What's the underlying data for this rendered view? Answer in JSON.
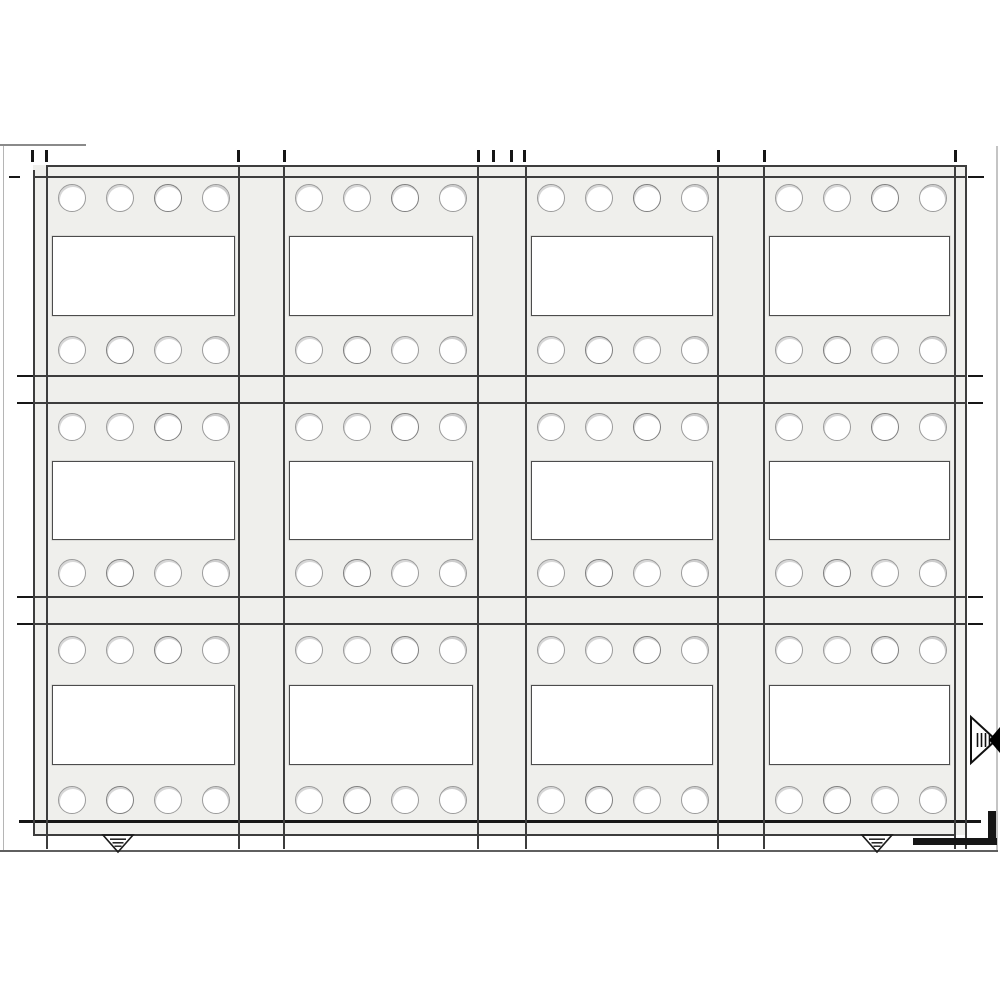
{
  "drawing": {
    "colors": {
      "paper": "#ffffff",
      "panel_fill": "#efefec",
      "line": "#3d3d3d",
      "heavy": "#161616",
      "circle_stroke": "#9b9b9b",
      "window_stroke": "#4c4c4c",
      "sheet_edge": "#b5b5b5",
      "ground_line": "#5f5f5f"
    },
    "band": {
      "x": 33,
      "y": 165,
      "w": 933,
      "h": 670
    },
    "grid": {
      "columns": [
        {
          "x": 46,
          "w": 193
        },
        {
          "x": 283,
          "w": 194
        },
        {
          "x": 525,
          "w": 192
        },
        {
          "x": 763,
          "w": 191
        }
      ],
      "rows": [
        {
          "y": 176,
          "h": 199,
          "top_circle_cy": 198,
          "window_y": 236,
          "window_h": 80,
          "bottom_circle_cy": 350
        },
        {
          "y": 403,
          "h": 193,
          "top_circle_cy": 427,
          "window_y": 461,
          "window_h": 79,
          "bottom_circle_cy": 573
        },
        {
          "y": 624,
          "h": 196,
          "top_circle_cy": 650,
          "window_y": 685,
          "window_h": 80,
          "bottom_circle_cy": 800
        }
      ],
      "circle_cx_offsets": [
        26,
        74,
        122,
        170
      ],
      "circle_r": 14,
      "window_inset_left": 6,
      "window_inset_total": 10
    },
    "lines": {
      "horizontal": [
        {
          "y": 165,
          "x1": 46,
          "x2": 966
        },
        {
          "y": 176,
          "x1": 33,
          "x2": 966
        },
        {
          "y": 375,
          "x1": 33,
          "x2": 966
        },
        {
          "y": 402,
          "x1": 33,
          "x2": 966
        },
        {
          "y": 596,
          "x1": 33,
          "x2": 966
        },
        {
          "y": 623,
          "x1": 33,
          "x2": 966
        },
        {
          "y": 820,
          "x1": 19,
          "x2": 981,
          "t": 2.5,
          "heavy": true
        },
        {
          "y": 834,
          "x1": 33,
          "x2": 956
        }
      ],
      "vertical": [
        {
          "x": 33,
          "y1": 170,
          "y2": 835
        },
        {
          "x": 46,
          "y1": 165,
          "y2": 849
        },
        {
          "x": 238,
          "y1": 166,
          "y2": 849
        },
        {
          "x": 283,
          "y1": 166,
          "y2": 849
        },
        {
          "x": 477,
          "y1": 166,
          "y2": 849
        },
        {
          "x": 525,
          "y1": 166,
          "y2": 849
        },
        {
          "x": 717,
          "y1": 166,
          "y2": 849
        },
        {
          "x": 763,
          "y1": 166,
          "y2": 849
        },
        {
          "x": 954,
          "y1": 165,
          "y2": 849
        },
        {
          "x": 965,
          "y1": 165,
          "y2": 849
        }
      ],
      "edge_dashes": [
        {
          "x": 9,
          "y": 176,
          "w": 11
        },
        {
          "x": 17,
          "y": 375,
          "w": 16
        },
        {
          "x": 17,
          "y": 402,
          "w": 16
        },
        {
          "x": 17,
          "y": 596,
          "w": 16
        },
        {
          "x": 17,
          "y": 623,
          "w": 16
        },
        {
          "x": 968,
          "y": 176,
          "w": 16
        },
        {
          "x": 968,
          "y": 375,
          "w": 15
        },
        {
          "x": 968,
          "y": 402,
          "w": 15
        },
        {
          "x": 968,
          "y": 596,
          "w": 15
        },
        {
          "x": 968,
          "y": 623,
          "w": 15
        }
      ]
    },
    "ticks": {
      "y": 150,
      "h": 12,
      "w": 2.5,
      "x": [
        31,
        45,
        237,
        283,
        477,
        492,
        510,
        523,
        717,
        763,
        954
      ]
    },
    "markers": {
      "datum": [
        {
          "x": 100,
          "y": 833
        },
        {
          "x": 859,
          "y": 833
        }
      ],
      "section_arrow": {
        "x": 969,
        "y": 712
      },
      "corner_h": {
        "x": 913,
        "y": 838,
        "w": 84,
        "h": 7
      },
      "corner_v": {
        "x": 988,
        "y": 811,
        "w": 8,
        "h": 34
      }
    },
    "sheet_edges": {
      "left": {
        "x": 3,
        "y": 146,
        "w": 1,
        "h": 705
      },
      "right": {
        "x": 996,
        "y": 146,
        "w": 1.5,
        "h": 705
      },
      "top_seg": {
        "x": 0,
        "y": 144,
        "w": 86,
        "h": 1.5
      },
      "ground": {
        "x": 0,
        "y": 850,
        "w": 998,
        "h": 2
      }
    }
  }
}
